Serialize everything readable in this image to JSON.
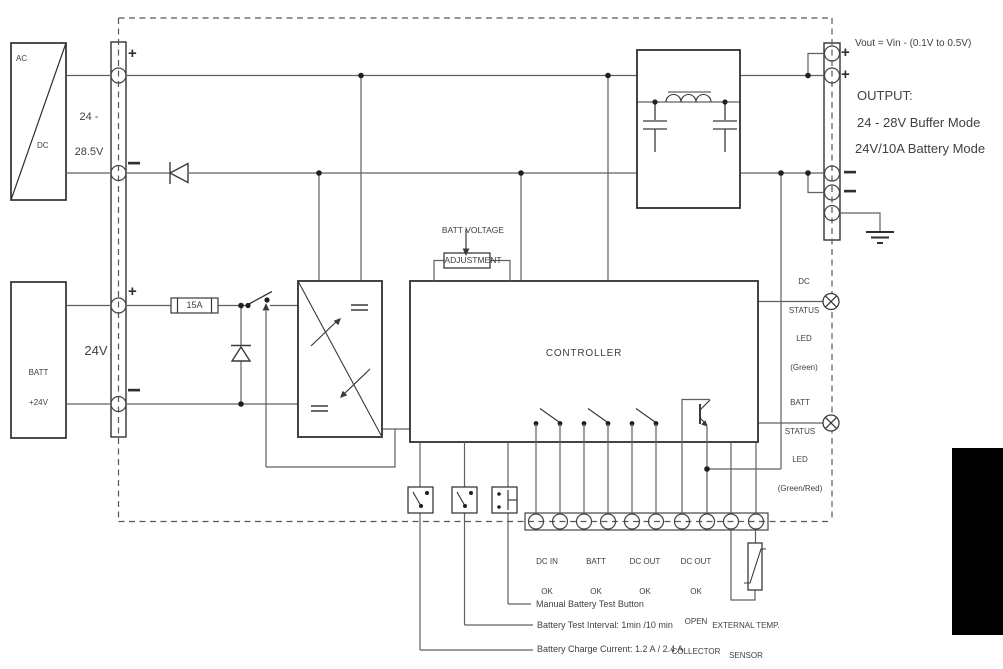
{
  "diagram": {
    "acdc": {
      "label_top": "AC",
      "label_bottom": "DC",
      "range": [
        "24 -",
        "28.5V"
      ]
    },
    "battery": {
      "label": [
        "BATT",
        "+24V"
      ],
      "bus_voltage": "24V",
      "fuse": "15A"
    },
    "polarity": {
      "plus": "+",
      "minus": "−"
    },
    "adjustment": {
      "label": [
        "BATT VOLTAGE",
        "ADJUSTMENT"
      ]
    },
    "controller": {
      "label": "CONTROLLER"
    },
    "output": {
      "note": "Vout = Vin - (0.1V to 0.5V)",
      "heading": "OUTPUT:",
      "modes": [
        "24 - 28V Buffer Mode",
        "24V/10A Battery Mode"
      ]
    },
    "leds": {
      "dc": [
        "DC",
        "STATUS",
        "LED",
        "(Green)"
      ],
      "batt": [
        "BATT",
        "STATUS",
        "LED",
        "(Green/Red)"
      ]
    },
    "terminals": {
      "dc_in": [
        "DC IN",
        "OK"
      ],
      "batt": [
        "BATT",
        "OK"
      ],
      "dc_out": [
        "DC OUT",
        "OK"
      ],
      "dc_out_oc": [
        "DC OUT",
        "OK",
        "OPEN",
        "COLLECTOR"
      ]
    },
    "temp_sensor": [
      "EXTERNAL TEMP.",
      "SENSOR",
      "Traco S/N: TSP-TS"
    ],
    "annotations": [
      "Manual Battery Test Button",
      "Battery Test Interval: 1min /10 min",
      "Battery Charge Current: 1.2 A / 2.4 A"
    ]
  },
  "colors": {
    "wire": "#606060",
    "outline": "#2f2f2f",
    "text": "#414042",
    "dashed": "#575757",
    "background": "#ffffff",
    "panel": "#000000"
  }
}
